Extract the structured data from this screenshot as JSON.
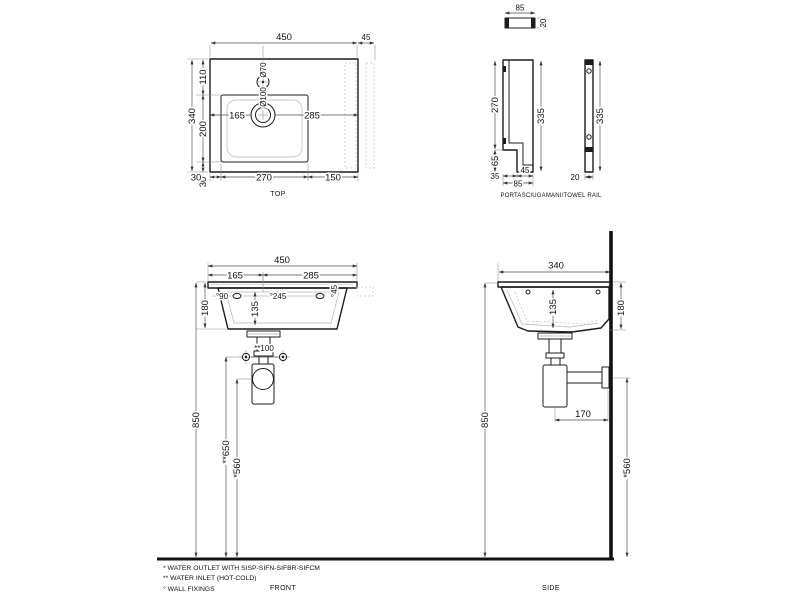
{
  "drawing": {
    "type": "technical-dimension-drawing",
    "subject": "wall-hung washbasin with towel rail",
    "colors": {
      "line": "#1c1c1c",
      "background": "#ffffff",
      "dim": "#4a4a4a"
    }
  },
  "top": {
    "caption": "TOP",
    "width": "450",
    "rail_offset": "45",
    "back": "110",
    "bowl_depth": "200",
    "depth": "340",
    "front": "30",
    "left": "30",
    "bowl_width": "270",
    "right": "150",
    "center_left": "165",
    "center_right": "285",
    "faucet_dia": "Ø70",
    "drain_dia": "Ø100"
  },
  "rail": {
    "caption": "PORTASCIUGAMANI/TOWEL RAIL",
    "plan_width": "85",
    "plan_thickness": "20",
    "slot_height": "270",
    "height": "335",
    "hook_height": "65",
    "hook_inset": "35",
    "hook_width": "45",
    "overall_width": "85",
    "front_height": "335",
    "front_thickness": "20"
  },
  "front": {
    "caption": "FRONT",
    "width": "450",
    "center_left": "165",
    "center_right": "285",
    "fix_left": "°90",
    "fix_span": "°245",
    "fix_right": "°45",
    "height": "180",
    "bowl_depth": "135",
    "inlet_span": "**100",
    "rim_height": "850",
    "inlet_height": "**650",
    "outlet_height": "*560"
  },
  "side": {
    "caption": "SIDE",
    "depth": "340",
    "bowl_depth": "135",
    "height": "180",
    "trap_offset": "170",
    "rim_height": "850",
    "outlet_height": "*560"
  },
  "notes": {
    "outlet": "* WATER OUTLET WITH SISP-SIFN-SIFBR-SIFCM",
    "inlet": "** WATER INLET  (HOT-COLD)",
    "fixings": "° WALL FIXINGS"
  }
}
